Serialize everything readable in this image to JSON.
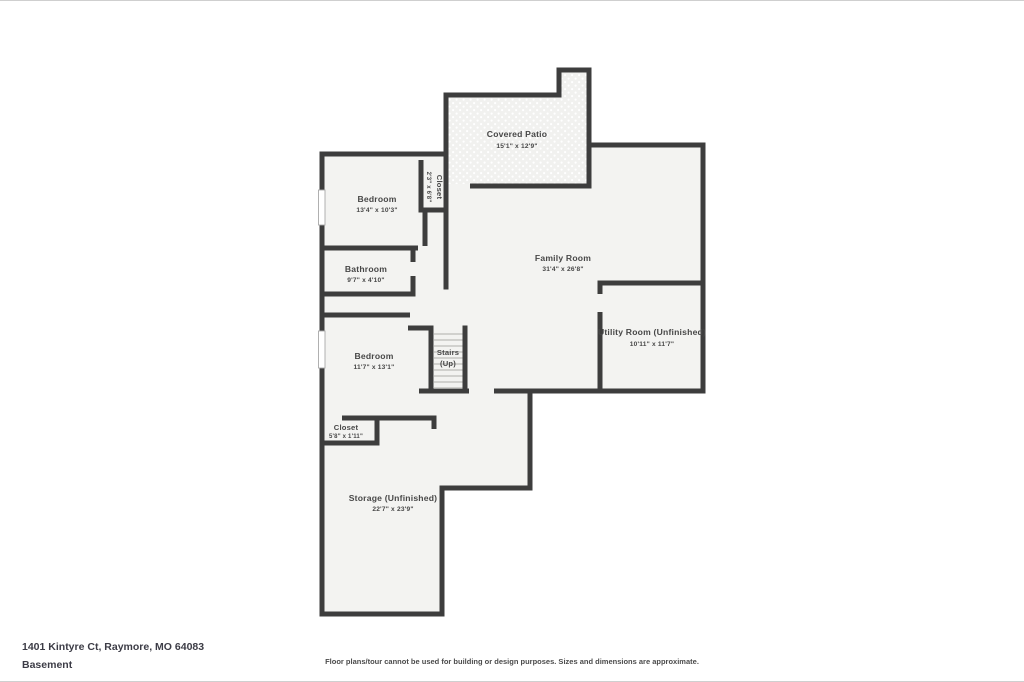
{
  "colors": {
    "wall": "#3d3d3d",
    "room_fill": "#f3f3f1",
    "patio_base": "#f1f1ef",
    "label_text": "#474747",
    "footer_text": "#3c3c46"
  },
  "floorplan": {
    "rooms": {
      "covered_patio": {
        "name": "Covered Patio",
        "dims": "15'1\" x 12'9\""
      },
      "closet_upper": {
        "name": "Closet",
        "dims": "2'3\" x 6'8\""
      },
      "bedroom_upper": {
        "name": "Bedroom",
        "dims": "13'4\" x 10'3\""
      },
      "bathroom": {
        "name": "Bathroom",
        "dims": "9'7\" x 4'10\""
      },
      "family_room": {
        "name": "Family Room",
        "dims": "31'4\" x 26'8\""
      },
      "utility_room": {
        "name": "Utility Room (Unfinished)",
        "dims": "10'11\" x 11'7\""
      },
      "stairs": {
        "name": "Stairs",
        "dims": "(Up)"
      },
      "bedroom_lower": {
        "name": "Bedroom",
        "dims": "11'7\" x 13'1\""
      },
      "closet_lower": {
        "name": "Closet",
        "dims": "5'8\" x 1'11\""
      },
      "storage": {
        "name": "Storage (Unfinished)",
        "dims": "22'7\" x 23'9\""
      }
    }
  },
  "footer": {
    "address": "1401 Kintyre Ct, Raymore, MO 64083",
    "floor_label": "Basement",
    "disclaimer": "Floor plans/tour cannot be used for building or design purposes. Sizes and dimensions are approximate."
  }
}
